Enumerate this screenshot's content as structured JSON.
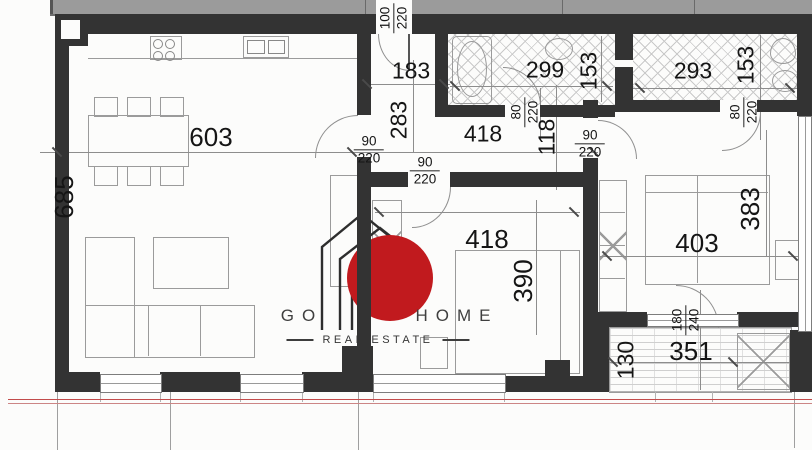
{
  "plan_title": "apartment-floor-plan",
  "rooms": {
    "living": {
      "name": "living-room-kitchen",
      "w": "603",
      "h": "685"
    },
    "hall": {
      "name": "entrance-hall",
      "w": "183",
      "h": "283"
    },
    "bath1": {
      "name": "bathroom-1",
      "w": "299",
      "h": "153"
    },
    "bath2": {
      "name": "bathroom-2",
      "w": "293",
      "h": "153"
    },
    "corridor": {
      "name": "corridor",
      "w": "418",
      "h": "118"
    },
    "bedroom1": {
      "name": "bedroom-1",
      "w": "418",
      "h": "390"
    },
    "bedroom2": {
      "name": "bedroom-2",
      "w": "403",
      "h": "383"
    },
    "balcony": {
      "name": "balcony",
      "w": "351",
      "h": "130"
    }
  },
  "doors": {
    "entrance": {
      "w": "100",
      "h": "220"
    },
    "living": {
      "w": "90",
      "h": "220"
    },
    "bath1": {
      "w": "80",
      "h": "220"
    },
    "bath2": {
      "w": "80",
      "h": "220"
    },
    "bedroom1": {
      "w": "90",
      "h": "220"
    },
    "bedroom2": {
      "w": "90",
      "h": "220"
    },
    "balcony": {
      "w": "180",
      "h": "240"
    }
  },
  "watermark": {
    "word_left": "GO",
    "word_right": "HOME",
    "tagline": "REAL ESTATE"
  },
  "colors": {
    "logo_red": "#c11a1e",
    "wall": "#333333",
    "common_area_gray": "#9b9b9b",
    "section_line_red": "#c24b4b"
  }
}
